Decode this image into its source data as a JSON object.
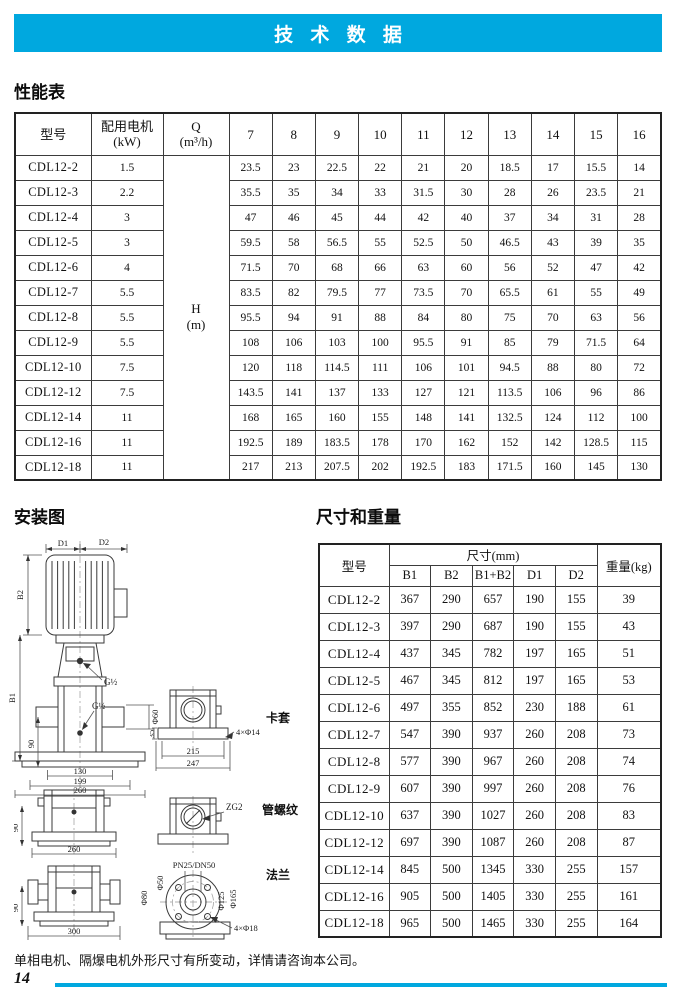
{
  "page": {
    "title_bar": "技 术 数 据",
    "footer_note": "单相电机、隔爆电机外形尺寸有所变动，详情请咨询本公司。",
    "page_number": "14",
    "accent_color": "#00a8df"
  },
  "performance": {
    "title": "性能表",
    "col_model": "型号",
    "col_motor": [
      "配用电机",
      "(kW)"
    ],
    "col_q": [
      "Q",
      "(m³/h)"
    ],
    "flow_columns": [
      "7",
      "8",
      "9",
      "10",
      "11",
      "12",
      "13",
      "14",
      "15",
      "16"
    ],
    "h_label": [
      "H",
      "(m)"
    ],
    "rows": [
      {
        "model": "CDL12-2",
        "motor": "1.5",
        "heads": [
          "23.5",
          "23",
          "22.5",
          "22",
          "21",
          "20",
          "18.5",
          "17",
          "15.5",
          "14"
        ]
      },
      {
        "model": "CDL12-3",
        "motor": "2.2",
        "heads": [
          "35.5",
          "35",
          "34",
          "33",
          "31.5",
          "30",
          "28",
          "26",
          "23.5",
          "21"
        ]
      },
      {
        "model": "CDL12-4",
        "motor": "3",
        "heads": [
          "47",
          "46",
          "45",
          "44",
          "42",
          "40",
          "37",
          "34",
          "31",
          "28"
        ]
      },
      {
        "model": "CDL12-5",
        "motor": "3",
        "heads": [
          "59.5",
          "58",
          "56.5",
          "55",
          "52.5",
          "50",
          "46.5",
          "43",
          "39",
          "35"
        ]
      },
      {
        "model": "CDL12-6",
        "motor": "4",
        "heads": [
          "71.5",
          "70",
          "68",
          "66",
          "63",
          "60",
          "56",
          "52",
          "47",
          "42"
        ]
      },
      {
        "model": "CDL12-7",
        "motor": "5.5",
        "heads": [
          "83.5",
          "82",
          "79.5",
          "77",
          "73.5",
          "70",
          "65.5",
          "61",
          "55",
          "49"
        ]
      },
      {
        "model": "CDL12-8",
        "motor": "5.5",
        "heads": [
          "95.5",
          "94",
          "91",
          "88",
          "84",
          "80",
          "75",
          "70",
          "63",
          "56"
        ]
      },
      {
        "model": "CDL12-9",
        "motor": "5.5",
        "heads": [
          "108",
          "106",
          "103",
          "100",
          "95.5",
          "91",
          "85",
          "79",
          "71.5",
          "64"
        ]
      },
      {
        "model": "CDL12-10",
        "motor": "7.5",
        "heads": [
          "120",
          "118",
          "114.5",
          "111",
          "106",
          "101",
          "94.5",
          "88",
          "80",
          "72"
        ]
      },
      {
        "model": "CDL12-12",
        "motor": "7.5",
        "heads": [
          "143.5",
          "141",
          "137",
          "133",
          "127",
          "121",
          "113.5",
          "106",
          "96",
          "86"
        ]
      },
      {
        "model": "CDL12-14",
        "motor": "11",
        "heads": [
          "168",
          "165",
          "160",
          "155",
          "148",
          "141",
          "132.5",
          "124",
          "112",
          "100"
        ]
      },
      {
        "model": "CDL12-16",
        "motor": "11",
        "heads": [
          "192.5",
          "189",
          "183.5",
          "178",
          "170",
          "162",
          "152",
          "142",
          "128.5",
          "115"
        ]
      },
      {
        "model": "CDL12-18",
        "motor": "11",
        "heads": [
          "217",
          "213",
          "207.5",
          "202",
          "192.5",
          "183",
          "171.5",
          "160",
          "145",
          "130"
        ]
      }
    ]
  },
  "installation": {
    "title": "安装图",
    "main": {
      "d1": "D1",
      "d2": "D2",
      "b1": "B1",
      "b2": "B2",
      "g1": "G½",
      "g2": "G½",
      "h90": "90",
      "w130": "130",
      "w199": "199",
      "w260": "260",
      "dia60": "Φ60"
    },
    "clamp": {
      "label": "卡套",
      "h35": "35",
      "w215": "215",
      "w247": "247",
      "holes": "4×Φ14"
    },
    "base1": {
      "h90": "90",
      "w260": "260"
    },
    "thread": {
      "label": "管螺纹",
      "code": "ZG2"
    },
    "base2": {
      "h90": "90",
      "w300": "300"
    },
    "flange": {
      "label": "法兰",
      "pn": "PN25/DN50",
      "d50": "Φ50",
      "d80": "Φ80",
      "d125": "Φ125",
      "d165": "Φ165",
      "holes": "4×Φ18"
    }
  },
  "dimensions": {
    "title": "尺寸和重量",
    "col_model": "型号",
    "size_group": "尺寸(mm)",
    "size_cols": [
      "B1",
      "B2",
      "B1+B2",
      "D1",
      "D2"
    ],
    "col_weight": "重量(kg)",
    "rows": [
      {
        "model": "CDL12-2",
        "values": [
          "367",
          "290",
          "657",
          "190",
          "155",
          "39"
        ]
      },
      {
        "model": "CDL12-3",
        "values": [
          "397",
          "290",
          "687",
          "190",
          "155",
          "43"
        ]
      },
      {
        "model": "CDL12-4",
        "values": [
          "437",
          "345",
          "782",
          "197",
          "165",
          "51"
        ]
      },
      {
        "model": "CDL12-5",
        "values": [
          "467",
          "345",
          "812",
          "197",
          "165",
          "53"
        ]
      },
      {
        "model": "CDL12-6",
        "values": [
          "497",
          "355",
          "852",
          "230",
          "188",
          "61"
        ]
      },
      {
        "model": "CDL12-7",
        "values": [
          "547",
          "390",
          "937",
          "260",
          "208",
          "73"
        ]
      },
      {
        "model": "CDL12-8",
        "values": [
          "577",
          "390",
          "967",
          "260",
          "208",
          "74"
        ]
      },
      {
        "model": "CDL12-9",
        "values": [
          "607",
          "390",
          "997",
          "260",
          "208",
          "76"
        ]
      },
      {
        "model": "CDL12-10",
        "values": [
          "637",
          "390",
          "1027",
          "260",
          "208",
          "83"
        ]
      },
      {
        "model": "CDL12-12",
        "values": [
          "697",
          "390",
          "1087",
          "260",
          "208",
          "87"
        ]
      },
      {
        "model": "CDL12-14",
        "values": [
          "845",
          "500",
          "1345",
          "330",
          "255",
          "157"
        ]
      },
      {
        "model": "CDL12-16",
        "values": [
          "905",
          "500",
          "1405",
          "330",
          "255",
          "161"
        ]
      },
      {
        "model": "CDL12-18",
        "values": [
          "965",
          "500",
          "1465",
          "330",
          "255",
          "164"
        ]
      }
    ]
  }
}
